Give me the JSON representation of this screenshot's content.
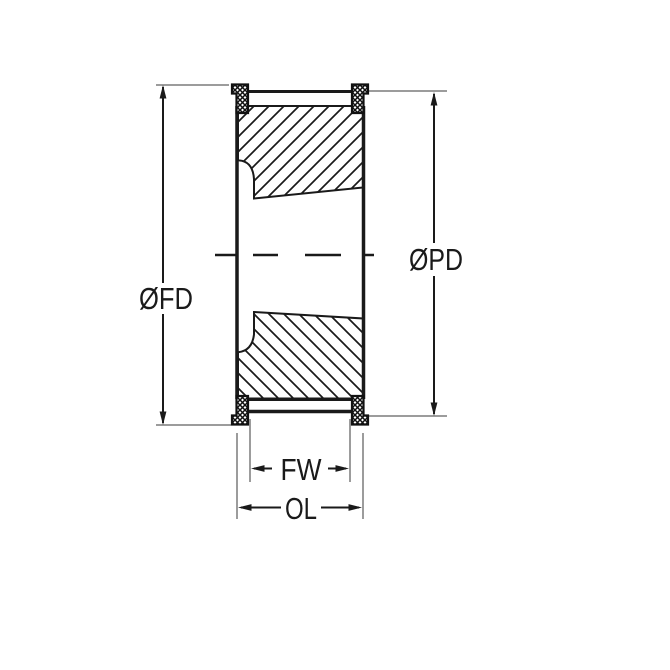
{
  "diagram": {
    "labels": {
      "flange_diameter": "ØFD",
      "pitch_diameter": "ØPD",
      "face_width": "FW",
      "overall_length": "OL"
    },
    "colors": {
      "line": "#1a1a1a",
      "extension_line": "#9c9c9c",
      "background": "#ffffff"
    }
  }
}
